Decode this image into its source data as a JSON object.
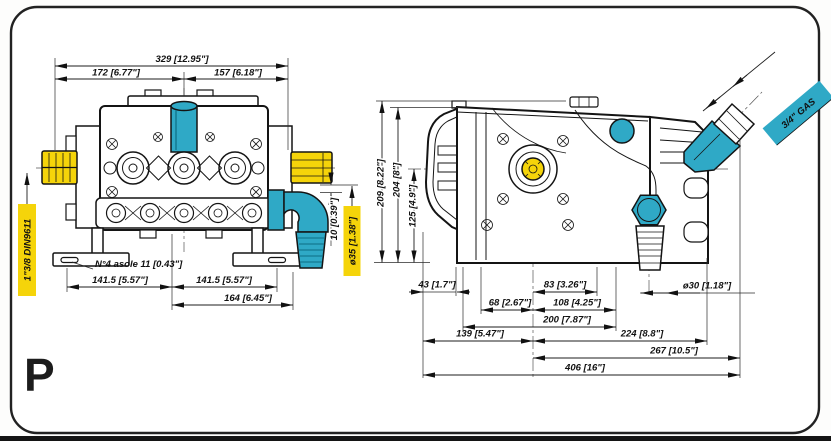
{
  "meta": {
    "model_letter": "P"
  },
  "colors": {
    "cyan": "#2FA9C6",
    "yellow": "#F5D40A"
  },
  "front_view": {
    "dims": {
      "total_width": "329 [12.95\"]",
      "left_width": "172 [6.77\"]",
      "right_width": "157 [6.18\"]",
      "feet_left": "141.5 [5.57\"]",
      "feet_right": "141.5 [5.57\"]",
      "outlet_offset": "164 [6.45\"]",
      "stub_height": "10 [0.39\"]",
      "hose_od": "ø35 [1.38\"]",
      "slots_note": "N°4 asole 11 [0.43\"]",
      "shaft_spline": "1\"3/8 DIN9611"
    }
  },
  "side_view": {
    "dims": {
      "height_total": "209 [8.22\"]",
      "height_top": "204 [8\"]",
      "height_shaft": "125 [4.9\"]",
      "a43": "43 [1.7\"]",
      "b83": "83 [3.26\"]",
      "c68": "68 [2.67\"]",
      "d108": "108 [4.25\"]",
      "e200": "200 [7.87\"]",
      "f139": "139 [5.47\"]",
      "g224": "224 [8.8\"]",
      "h267": "267 [10.5\"]",
      "i406": "406 [16\"]",
      "hose_od": "ø30 [1.18\"]",
      "inlet_thread": "3/4\" GAS"
    }
  }
}
